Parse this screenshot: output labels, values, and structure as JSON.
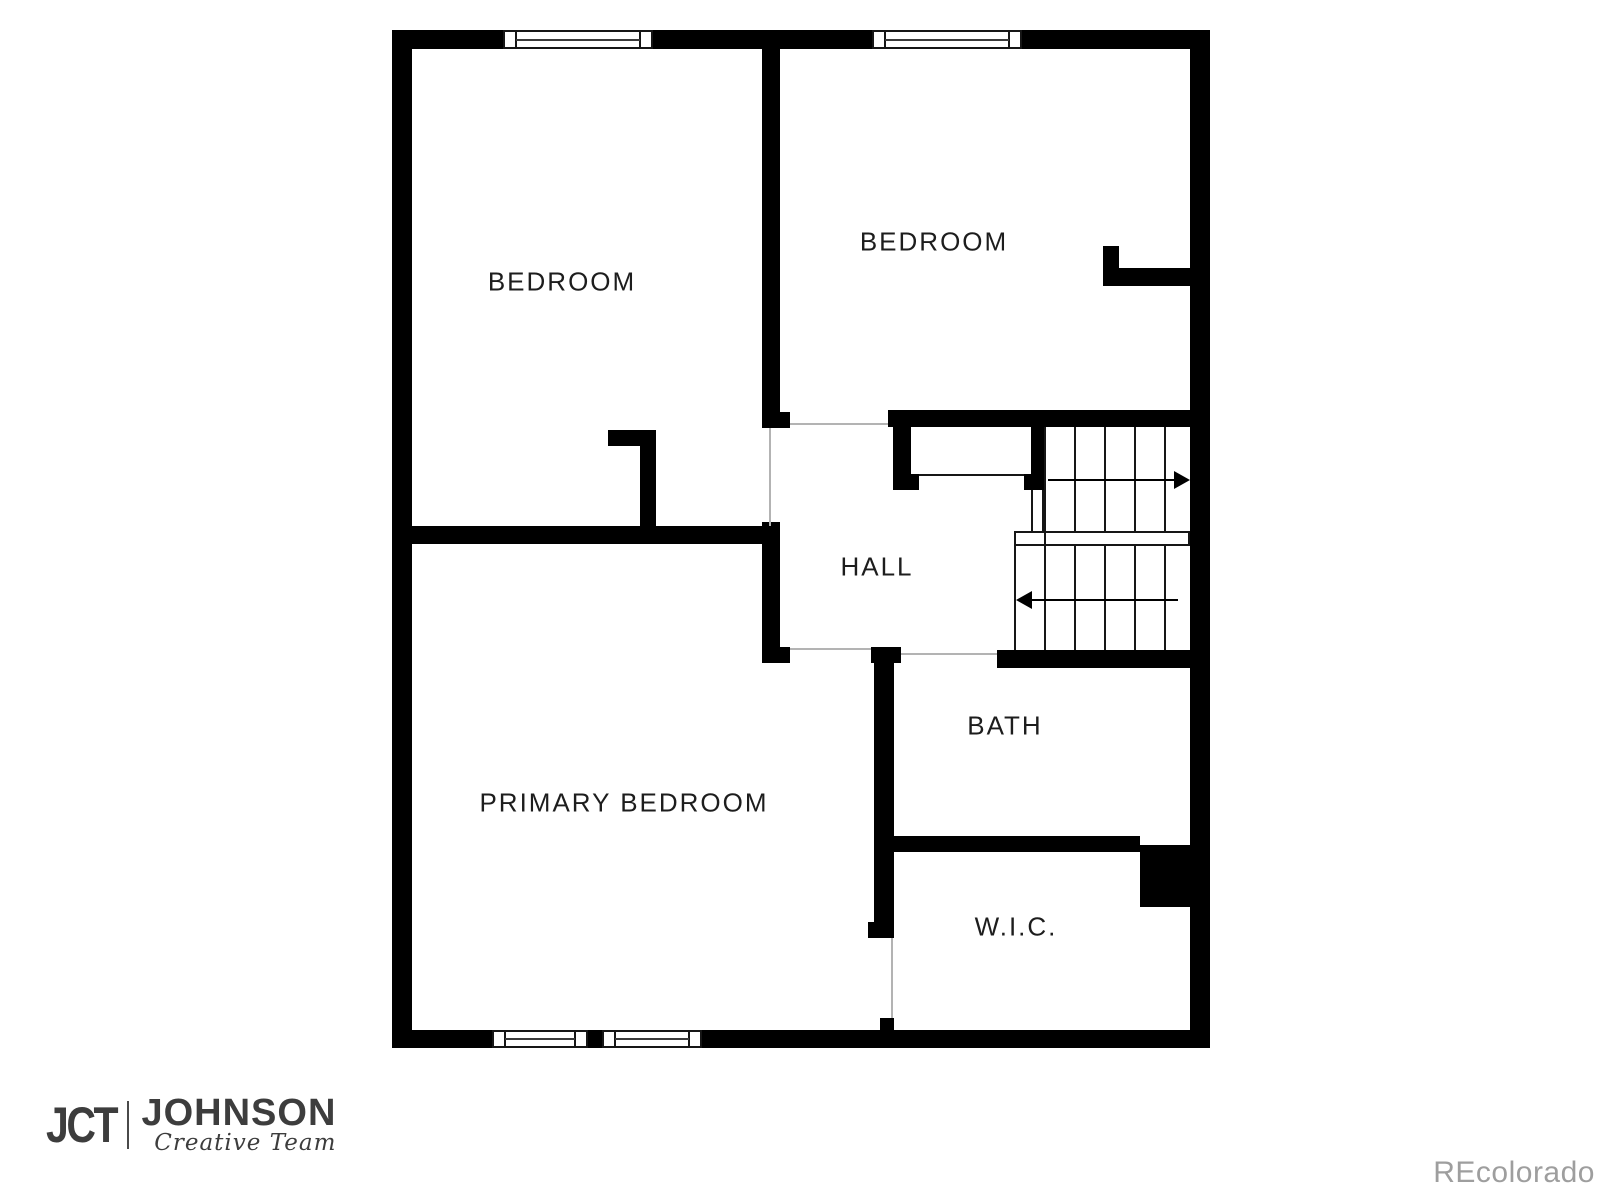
{
  "rooms": {
    "bedroom1": {
      "label": "BEDROOM"
    },
    "bedroom2": {
      "label": "BEDROOM"
    },
    "hall": {
      "label": "HALL"
    },
    "bath": {
      "label": "BATH"
    },
    "wic": {
      "label": "W.I.C."
    },
    "primary": {
      "label": "PRIMARY BEDROOM"
    }
  },
  "branding": {
    "mark": "JCT",
    "name": "JOHNSON",
    "tagline": "Creative Team"
  },
  "watermark": "REcolorado",
  "colors": {
    "wall": "#000000",
    "room_label": "#1d1d1d",
    "door_line": "#b3b3b3",
    "logo": "#3d3d3d",
    "watermark": "#9e9e9e"
  }
}
